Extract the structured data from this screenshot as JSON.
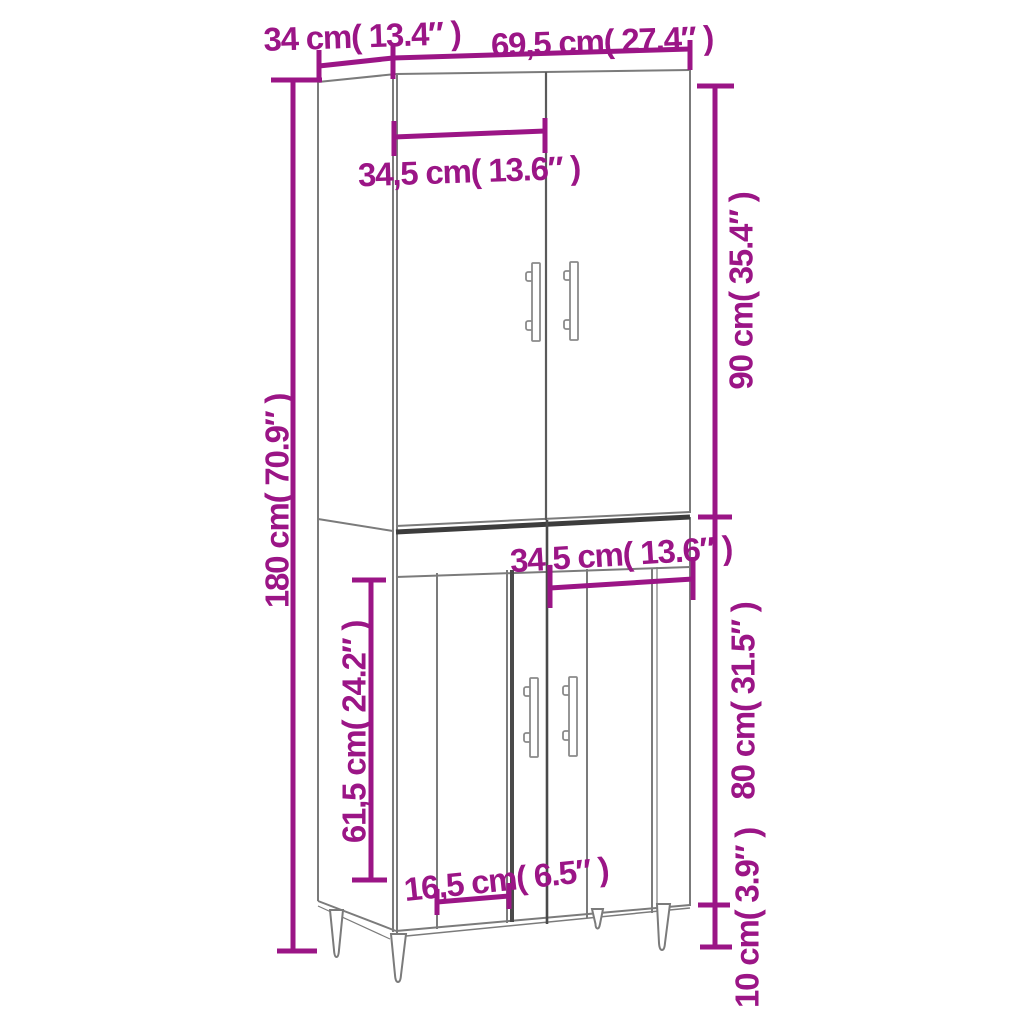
{
  "diagram": {
    "title": "Highboard cabinet dimension diagram",
    "accent_color": "#9b1586",
    "line_color": "#7b7b7b",
    "dimensions": {
      "depth": "34 cm( 13.4″ )",
      "width": "69,5 cm( 27.4″ )",
      "upper_door_width": "34,5 cm( 13.6″ )",
      "upper_section_height": "90 cm( 35.4″ )",
      "total_height": "180 cm( 70.9″ )",
      "lower_door_width": "34,5 cm( 13.6″ )",
      "lower_inner_height": "61,5 cm( 24.2″ )",
      "lower_section_height": "80 cm( 31.5″ )",
      "lower_panel_width": "16,5 cm( 6.5″ )",
      "leg_height": "10 cm( 3.9″ )"
    }
  }
}
